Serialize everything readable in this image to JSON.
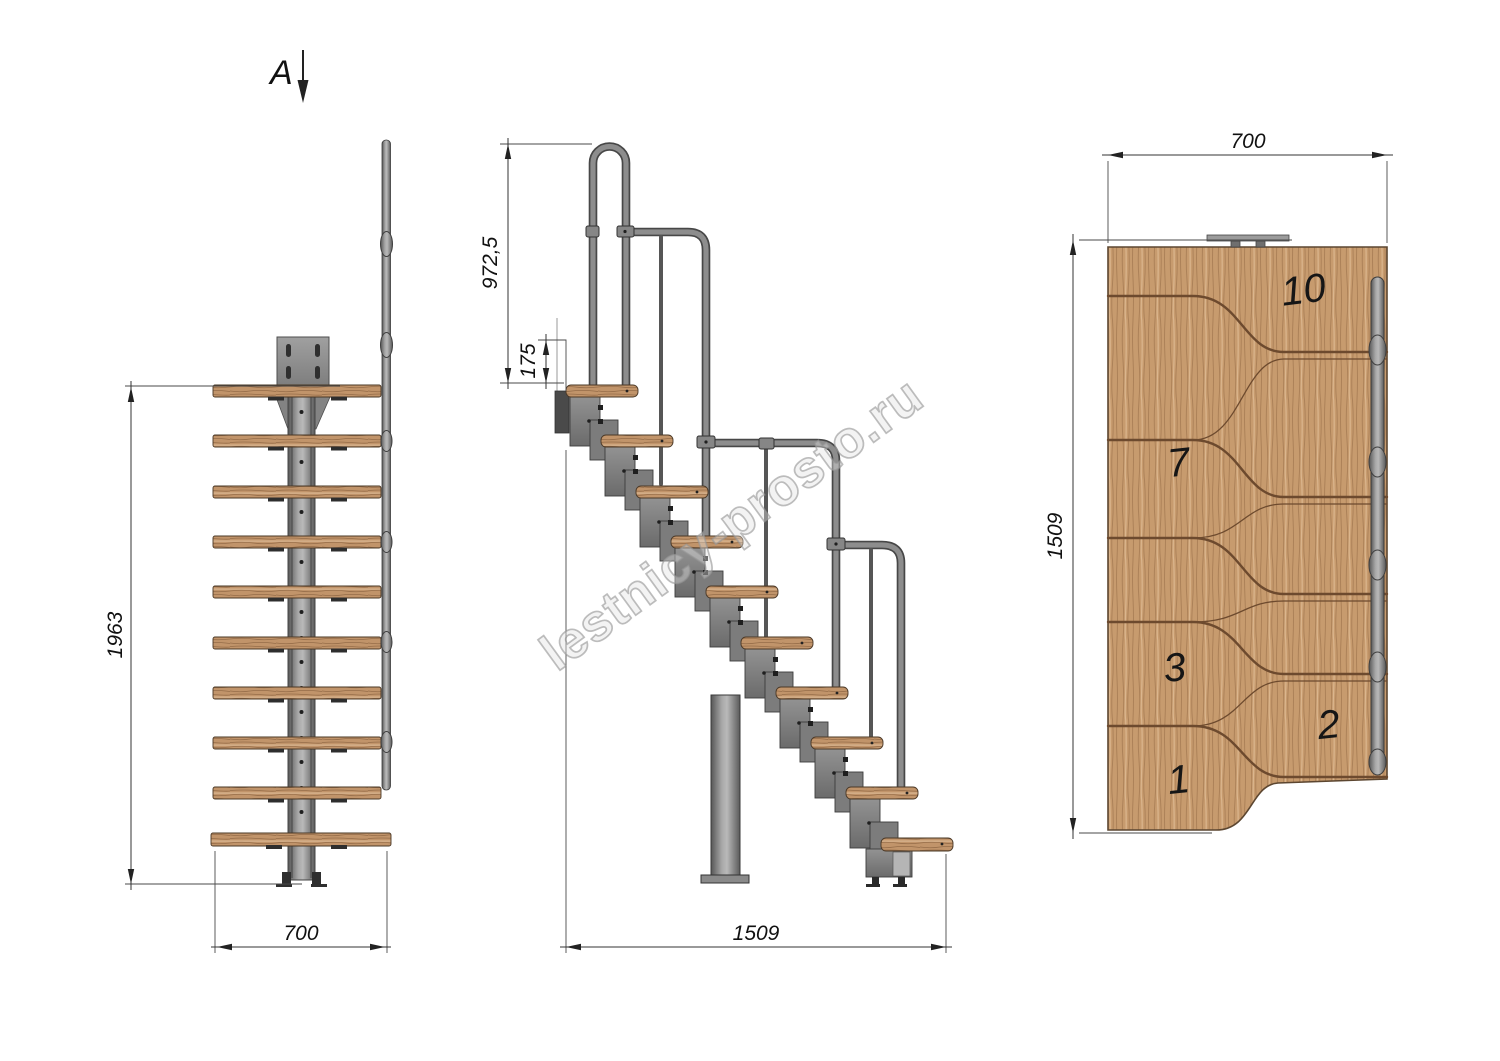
{
  "watermark": {
    "text": "lestnicy-prosto.ru"
  },
  "section_label": {
    "letter": "A"
  },
  "front_view": {
    "dim_height": "1963",
    "dim_width": "700"
  },
  "side_view": {
    "dim_rail_height": "972,5",
    "dim_step_rise": "175",
    "dim_run": "1509"
  },
  "plan_view": {
    "dim_width": "700",
    "dim_length": "1509",
    "step_numbers": [
      "10",
      "7",
      "3",
      "2",
      "1"
    ]
  },
  "colors": {
    "wood": "#c49a6e",
    "wood_line": "#6d4a2e",
    "metal": "#8f8f8f",
    "metal_dark": "#474747",
    "dimension_line": "#333333"
  }
}
